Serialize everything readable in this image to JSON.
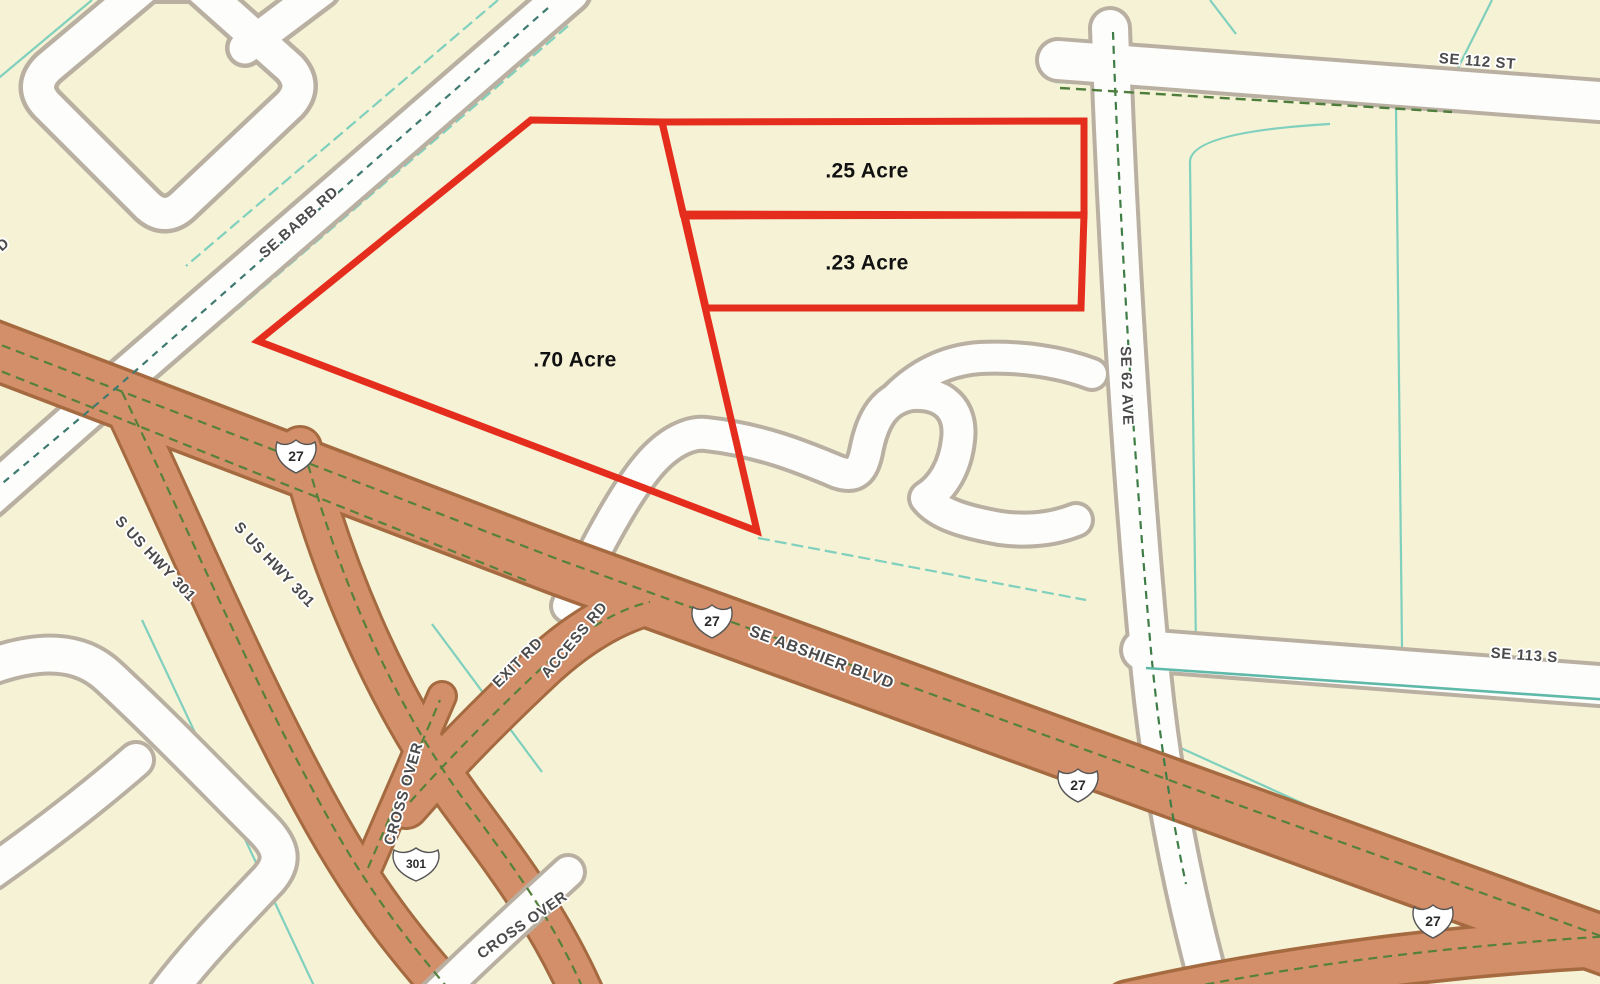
{
  "map_type": "parcel-gis-map",
  "colors": {
    "background": "#f5f2d6",
    "road_fill": "#fdfdfc",
    "road_casing": "#b9b0a2",
    "highway_fill": "#d28f6a",
    "highway_casing": "#a56a40",
    "highway_centerline": "#56813c",
    "parcel_line_teal": "#7fd0bd",
    "road_dash_dark": "#3f7a70",
    "parcel_outline_red": "#e52d1d",
    "label_gray": "#4b4b4b",
    "label_black": "#111111"
  },
  "parcels": [
    {
      "label": ".70 Acre"
    },
    {
      "label": ".25 Acre"
    },
    {
      "label": ".23 Acre"
    }
  ],
  "road_labels": [
    {
      "text": "SE BABB RD"
    },
    {
      "text": "SE 112 ST"
    },
    {
      "text": "SE 62 AVE"
    },
    {
      "text": "SE 113 S"
    },
    {
      "text": "SE ABSHIER BLVD"
    },
    {
      "text": "S US HWY 301"
    },
    {
      "text": "S US HWY 301"
    },
    {
      "text": "EXIT RD"
    },
    {
      "text": "ACCESS RD"
    },
    {
      "text": "CROSS OVER"
    },
    {
      "text": "CROSS OVER"
    },
    {
      "text": "D"
    }
  ],
  "shields": [
    {
      "route": "27"
    },
    {
      "route": "27"
    },
    {
      "route": "27"
    },
    {
      "route": "27"
    },
    {
      "route": "301"
    }
  ]
}
